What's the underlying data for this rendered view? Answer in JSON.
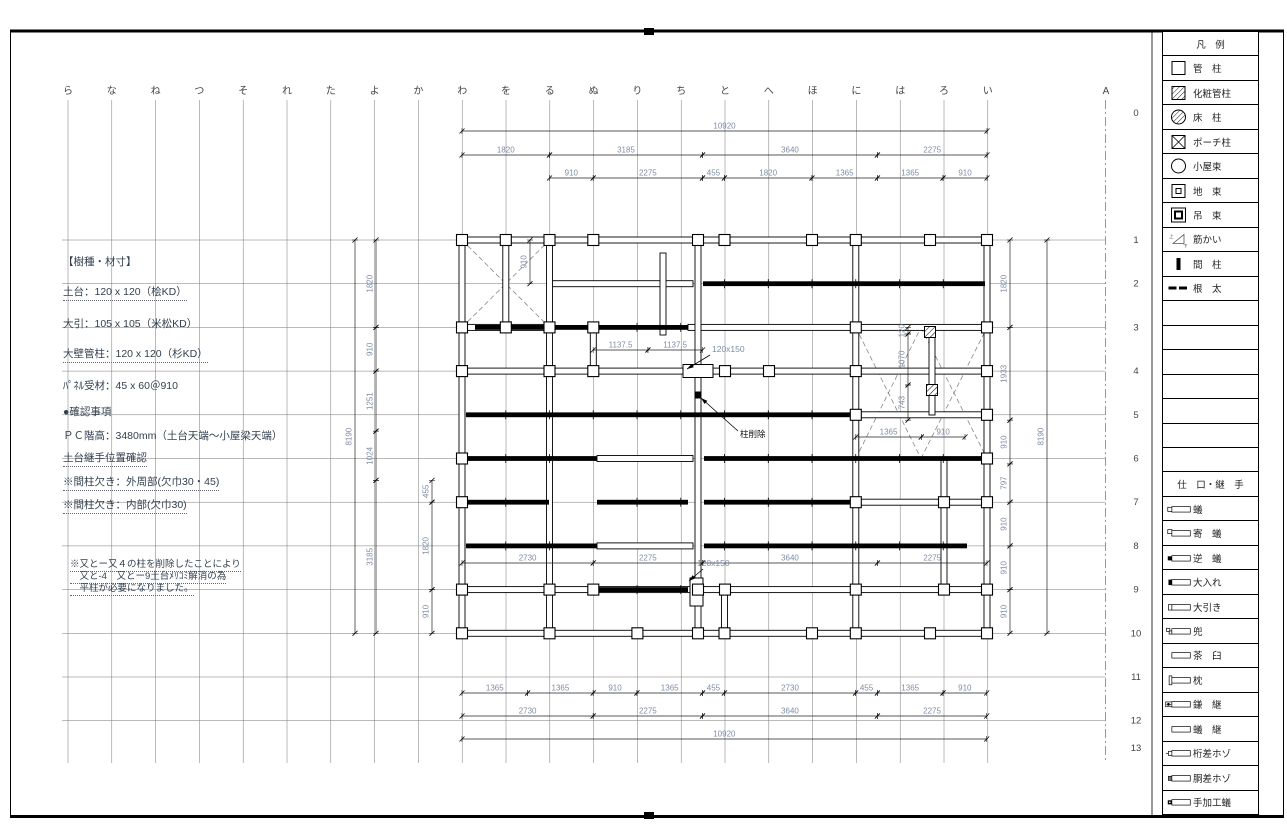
{
  "sheet": {
    "bg": "#ffffff",
    "line_color": "#000000",
    "dim_text_color": "#7e8da6",
    "note_text_color": "#33404f"
  },
  "grid": {
    "col_labels": [
      "ら",
      "な",
      "ね",
      "つ",
      "そ",
      "れ",
      "た",
      "よ",
      "か",
      "わ",
      "を",
      "る",
      "ぬ",
      "り",
      "ち",
      "と",
      "へ",
      "ほ",
      "に",
      "は",
      "ろ",
      "い"
    ],
    "axis_a_label": "A",
    "row_labels": [
      "0",
      "1",
      "2",
      "3",
      "4",
      "5",
      "6",
      "7",
      "8",
      "9",
      "10",
      "11",
      "12",
      "13"
    ]
  },
  "notes": {
    "material_title": "【樹種・材寸】",
    "material_lines": [
      "土台：120 x 120（桧KD）",
      "大引：105 x 105（米松KD）",
      "大壁管柱：120 x 120（杉KD）",
      "ﾊﾟﾈﾙ受材：45 x 60＠910"
    ],
    "confirm_title": "●確認事項",
    "confirm_lines": [
      "ＰＣ階高：3480mm（土台天端～小屋梁天端）",
      "土台継手位置確認",
      "※間柱欠き：外周部(欠巾30・45)",
      "※間柱欠き：内部(欠巾30)"
    ],
    "remark_lines": [
      "※又とー又４の柱を削除したことにより",
      "　又と-4　又とー9土台ﾒﾘｺﾐ解消の為",
      "　平柱が必要になりました。"
    ]
  },
  "legend": {
    "header": "凡　例",
    "items": [
      {
        "sym": "square",
        "label": "管　柱"
      },
      {
        "sym": "square-hatch",
        "label": "化粧管柱"
      },
      {
        "sym": "circle-hatch",
        "label": "床　柱"
      },
      {
        "sym": "square-x",
        "label": "ポーチ柱"
      },
      {
        "sym": "circle",
        "label": "小屋束"
      },
      {
        "sym": "square-inner",
        "label": "地　束"
      },
      {
        "sym": "square-double",
        "label": "吊　束"
      },
      {
        "sym": "brace",
        "label": "筋かい"
      },
      {
        "sym": "stud",
        "label": "間　柱"
      },
      {
        "sym": "joist",
        "label": "根　太"
      }
    ],
    "empty_rows": 7,
    "joints_header": "仕　口・継　手",
    "joints": [
      {
        "sym": "ari",
        "label": "蟻"
      },
      {
        "sym": "yose",
        "label": "寄　蟻"
      },
      {
        "sym": "gyaku",
        "label": "逆　蟻"
      },
      {
        "sym": "ooire",
        "label": "大入れ"
      },
      {
        "sym": "oobiki",
        "label": "大引き"
      },
      {
        "sym": "kabuto",
        "label": "兜"
      },
      {
        "sym": "chausu",
        "label": "茶　臼"
      },
      {
        "sym": "makura",
        "label": "枕"
      },
      {
        "sym": "kama",
        "label": "鎌　継"
      },
      {
        "sym": "aritsugi",
        "label": "蟻　継"
      },
      {
        "sym": "keta",
        "label": "桁差ホゾ"
      },
      {
        "sym": "dou",
        "label": "胴差ホゾ"
      },
      {
        "sym": "teka",
        "label": "手加工蟻"
      }
    ]
  },
  "plan": {
    "h_dims": [
      [
        462,
        987,
        131,
        "10920"
      ],
      [
        462,
        549.5,
        155,
        "1820"
      ],
      [
        549.5,
        702.5,
        155,
        "3185"
      ],
      [
        702.5,
        877.4,
        155,
        "3640"
      ],
      [
        877.4,
        987,
        155,
        "2275"
      ],
      [
        549.5,
        593.2,
        178,
        "910"
      ],
      [
        593.2,
        702.5,
        178,
        "2275"
      ],
      [
        702.5,
        724.4,
        178,
        "455"
      ],
      [
        724.4,
        811.9,
        178,
        "1820"
      ],
      [
        811.9,
        877.4,
        178,
        "1365"
      ],
      [
        877.4,
        943,
        178,
        "1365"
      ],
      [
        943,
        987,
        178,
        "910"
      ],
      [
        593.2,
        647.9,
        350,
        "1137.5"
      ],
      [
        647.9,
        702.5,
        350,
        "1137.5"
      ],
      [
        855.8,
        921.3,
        437,
        "1365"
      ],
      [
        921.3,
        965,
        437,
        "910"
      ],
      [
        462,
        593.2,
        563,
        "2730"
      ],
      [
        593.2,
        702.5,
        563,
        "2275"
      ],
      [
        702.5,
        877.4,
        563,
        "3640"
      ],
      [
        877.4,
        987,
        563,
        "2275"
      ],
      [
        462,
        527.6,
        693,
        "1365"
      ],
      [
        527.6,
        593.2,
        693,
        "1365"
      ],
      [
        593.2,
        636.9,
        693,
        "910"
      ],
      [
        636.9,
        702.5,
        693,
        "1365"
      ],
      [
        702.5,
        724.4,
        693,
        "455"
      ],
      [
        724.4,
        855.6,
        693,
        "2730"
      ],
      [
        855.6,
        877.4,
        693,
        "455"
      ],
      [
        877.4,
        943,
        693,
        "1365"
      ],
      [
        943,
        986.7,
        693,
        "910"
      ],
      [
        462,
        593.2,
        716,
        "2730"
      ],
      [
        593.2,
        702.5,
        716,
        "2275"
      ],
      [
        702.5,
        877.4,
        716,
        "3640"
      ],
      [
        877.4,
        986.7,
        716,
        "2275"
      ],
      [
        462,
        986.7,
        739,
        "10920"
      ]
    ],
    "v_dims": [
      [
        240,
        633.3,
        355,
        "8190"
      ],
      [
        240,
        327.4,
        376,
        "1820"
      ],
      [
        327.4,
        371.1,
        376,
        "910"
      ],
      [
        371.1,
        431.2,
        376,
        "1251"
      ],
      [
        431.2,
        480.4,
        376,
        "1024"
      ],
      [
        480.4,
        633.3,
        376,
        "3185"
      ],
      [
        480.4,
        502.2,
        432,
        "455"
      ],
      [
        502.2,
        589.6,
        432,
        "1820"
      ],
      [
        589.6,
        633.3,
        432,
        "910"
      ],
      [
        240,
        283.7,
        530,
        "910"
      ],
      [
        327.4,
        334,
        908,
        "120"
      ],
      [
        334,
        385,
        908,
        "1070"
      ],
      [
        385,
        420.2,
        908,
        "743"
      ],
      [
        240,
        327.4,
        1010,
        "1820"
      ],
      [
        327.4,
        420.2,
        1010,
        "1933"
      ],
      [
        420.2,
        463.9,
        1010,
        "910"
      ],
      [
        463.9,
        502.2,
        1010,
        "797"
      ],
      [
        502.2,
        545.9,
        1010,
        "910"
      ],
      [
        545.9,
        589.6,
        1010,
        "910"
      ],
      [
        589.6,
        633.3,
        1010,
        "910"
      ],
      [
        240,
        633.3,
        1047,
        "8190"
      ]
    ],
    "annotations": [
      [
        "120x150",
        712,
        352,
        710,
        355,
        687,
        369,
        "dim"
      ],
      [
        "柱削除",
        740,
        437,
        738,
        431,
        701,
        398,
        "ink"
      ],
      [
        "120x150",
        697,
        566,
        703,
        569,
        689,
        581,
        "dim"
      ]
    ],
    "sills_h": [
      [
        462,
        987,
        240
      ],
      [
        549.5,
        693,
        283.7
      ],
      [
        462,
        549.5,
        327.4
      ],
      [
        688,
        987,
        327.4
      ],
      [
        462,
        987,
        371.1
      ],
      [
        855.8,
        987,
        414.8
      ],
      [
        597,
        693,
        458.5
      ],
      [
        855.8,
        987,
        502.2
      ],
      [
        597,
        693,
        545.9
      ],
      [
        462,
        987,
        589.6
      ],
      [
        462,
        987,
        633.3
      ]
    ],
    "sills_v": [
      [
        462,
        240,
        633.3
      ],
      [
        505.8,
        240,
        327.4
      ],
      [
        549.5,
        240,
        633.3
      ],
      [
        593.3,
        327.4,
        371.1
      ],
      [
        663,
        253,
        335
      ],
      [
        698,
        240,
        633.3
      ],
      [
        724.5,
        589.6,
        633.3
      ],
      [
        855.8,
        240,
        633.3
      ],
      [
        932,
        333,
        415
      ],
      [
        944,
        458.5,
        589.6
      ],
      [
        987,
        240,
        633.3
      ]
    ],
    "beams": [
      [
        703,
        985,
        283.7
      ],
      [
        475,
        688,
        327.4
      ],
      [
        466,
        855,
        414.8
      ],
      [
        466,
        597,
        458.5
      ],
      [
        704,
        985,
        458.5
      ],
      [
        466,
        549,
        502.2
      ],
      [
        597,
        688,
        502.2
      ],
      [
        704,
        856,
        502.2
      ],
      [
        466,
        597,
        545.9
      ],
      [
        704,
        967,
        545.9
      ],
      [
        597,
        688,
        589.6
      ]
    ],
    "braces": [
      [
        462,
        240,
        549.5,
        327.4
      ],
      [
        855.8,
        327.4,
        921,
        458.5
      ],
      [
        921,
        327.4,
        987,
        458.5
      ]
    ],
    "columns": [
      [
        462,
        240
      ],
      [
        505.8,
        240
      ],
      [
        549.5,
        240
      ],
      [
        593.3,
        240
      ],
      [
        698,
        240
      ],
      [
        724.5,
        240
      ],
      [
        812,
        240
      ],
      [
        855.8,
        240
      ],
      [
        930,
        240
      ],
      [
        987,
        240
      ],
      [
        462,
        327.4
      ],
      [
        505.8,
        327.4
      ],
      [
        549.5,
        327.4
      ],
      [
        593.3,
        327.4
      ],
      [
        855.8,
        327.4
      ],
      [
        987,
        327.4
      ],
      [
        462,
        371.1
      ],
      [
        549.5,
        371.1
      ],
      [
        593.3,
        371.1
      ],
      [
        725,
        371.1
      ],
      [
        769,
        371.1
      ],
      [
        855.8,
        371.1
      ],
      [
        987,
        371.1
      ],
      [
        855.8,
        414.8
      ],
      [
        987,
        414.8
      ],
      [
        462,
        458.5
      ],
      [
        987,
        458.5
      ],
      [
        462,
        502.2
      ],
      [
        855.8,
        502.2
      ],
      [
        944,
        502.2
      ],
      [
        987,
        502.2
      ],
      [
        462,
        589.6
      ],
      [
        549.5,
        589.6
      ],
      [
        593.3,
        589.6
      ],
      [
        698,
        589.6
      ],
      [
        725,
        589.6
      ],
      [
        855.8,
        589.6
      ],
      [
        944,
        589.6
      ],
      [
        987,
        589.6
      ],
      [
        462,
        633.3
      ],
      [
        549.5,
        633.3
      ],
      [
        637.4,
        633.3
      ],
      [
        698,
        633.3
      ],
      [
        724.5,
        633.3
      ],
      [
        812,
        633.3
      ],
      [
        855.8,
        633.3
      ],
      [
        930,
        633.3
      ],
      [
        987,
        633.3
      ]
    ],
    "columns_hatched": [
      [
        930,
        332
      ],
      [
        932,
        390
      ]
    ],
    "columns_filled": [
      [
        698,
        395
      ]
    ],
    "boxes": [
      [
        683,
        364.5,
        30,
        13
      ],
      [
        690,
        578,
        13,
        28
      ]
    ]
  }
}
